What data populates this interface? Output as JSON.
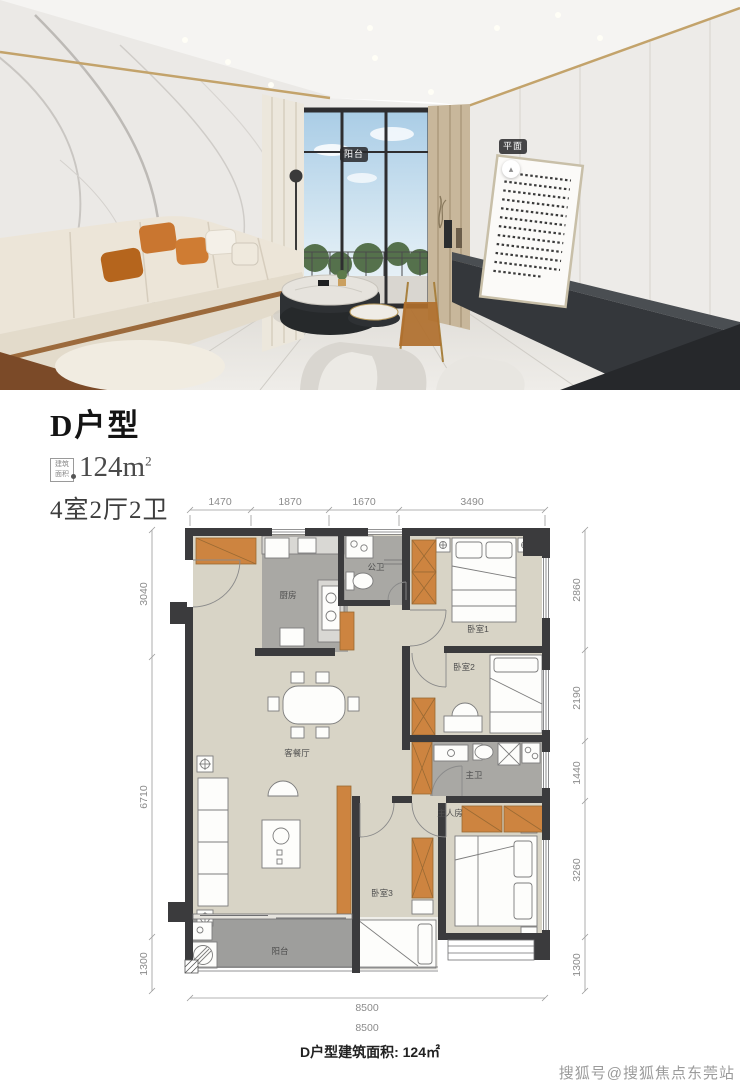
{
  "photo": {
    "hotspots": {
      "balcony": "阳台",
      "plan": "平面"
    }
  },
  "listing": {
    "title": "D户型",
    "area_badge": [
      "建筑",
      "面积"
    ],
    "area_value": "124m",
    "area_sup": "2",
    "layout": "4室2厅2卫"
  },
  "floorplan": {
    "rooms": {
      "living_dining": "客餐厅",
      "kitchen": "厨房",
      "guest_bath": "公卫",
      "bedroom1": "卧室1",
      "bedroom2": "卧室2",
      "master_bath": "主卫",
      "master_bedroom": "主人房",
      "bedroom3": "卧室3",
      "balcony": "阳台"
    },
    "dimensions": {
      "top": [
        "1470",
        "1870",
        "1670",
        "3490"
      ],
      "left": [
        "3040",
        "6710",
        "1300"
      ],
      "right": [
        "2860",
        "2190",
        "1440",
        "3260",
        "1300"
      ],
      "bottom": "8500",
      "bottom_total": "8500"
    }
  },
  "footer": {
    "area_text": "D户型建筑面积: 124㎡"
  },
  "watermark": {
    "text": "搜狐号@搜狐焦点东莞站"
  },
  "colors": {
    "wall": "#3b3b3d",
    "floor_beige": "#d8d4c6",
    "floor_gray": "#a9a8a4",
    "cabinet_orange": "#cd8440",
    "accent_gold": "#c3a36b"
  }
}
